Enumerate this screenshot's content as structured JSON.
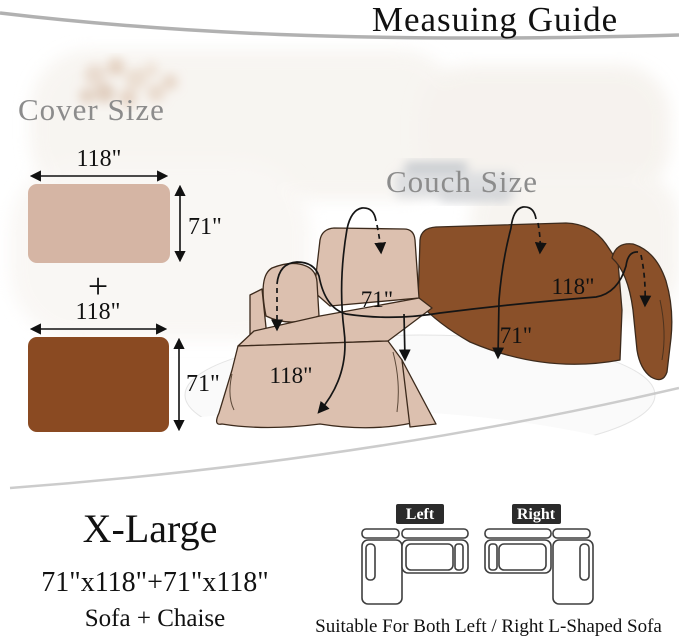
{
  "title": "Measuing Guide",
  "cover_size": {
    "heading": "Cover Size",
    "plus_sign": "+",
    "top_rect": {
      "width_label": "118\"",
      "height_label": "71\""
    },
    "bottom_rect": {
      "width_label": "118\"",
      "height_label": "71\""
    }
  },
  "couch_size": {
    "heading": "Couch Size",
    "chaise": {
      "depth_label": "71\"",
      "width_label": "118\""
    },
    "sofa": {
      "width_label": "118\"",
      "depth_label": "71\""
    }
  },
  "size_info": {
    "size_name": "X-Large",
    "dimensions": "71\"x118\"+71\"x118\"",
    "composition": "Sofa + Chaise"
  },
  "orientation_guide": {
    "left_badge": "Left",
    "right_badge": "Right",
    "caption": "Suitable For Both Left / Right L-Shaped Sofa"
  },
  "colors": {
    "tan_rect": "#d5b5a4",
    "brown_rect": "#8a4a22",
    "chaise_cover": "#dcc0af",
    "sofa_cover": "#8a5029",
    "heading_gray": "#8c8c8c",
    "badge_bg": "#2b2b2b",
    "badge_text": "#ffffff",
    "text_black": "#111111"
  }
}
